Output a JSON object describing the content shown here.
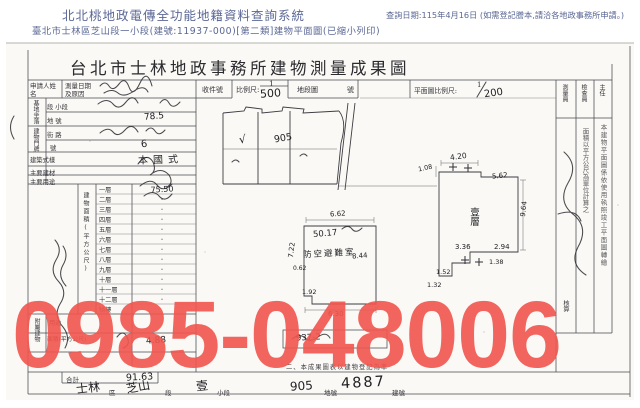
{
  "header": {
    "system_title": "北北桃地政電傳全功能地籍資料查詢系統",
    "query_note": "查詢日期:115年4月16日 (如需登記謄本,請洽各地政事務所申請。)",
    "doc_line": "臺北市士林區芝山段一小段(建號:11937-000)[第二類]建物平面圖(已縮小列印)"
  },
  "watermark": {
    "text": "0985-048006",
    "color": "#f2564e"
  },
  "form": {
    "title": "台北市士林地政事務所建物測量成果圖",
    "head": {
      "applicant": "申請人姓名",
      "survey": "測量日期及原因",
      "receipt": "收件號",
      "scale_label": "比例尺:",
      "scale_num": "1",
      "scale_den": "500",
      "sheet_label": "地段圖",
      "sheet_no": "號",
      "plan_scale_label": "平面圖比例尺:",
      "plan_scale_num": "1",
      "plan_scale_den": "200"
    },
    "info": {
      "group_site": "基地坐落",
      "group_door": "建物門牌",
      "row_section": "段 小段",
      "row_lot": "地 號",
      "lot_value": "78.5",
      "row_street": "街 路",
      "row_no": "號",
      "no_value": "6",
      "row_style": "建築式樣",
      "style_value": "本國式",
      "row_material": "主要建材",
      "row_usage": "主要用途"
    },
    "area": {
      "section_label": "建物面積(平方公尺)",
      "floor_rows": [
        {
          "label": "一層",
          "value": "75.50"
        },
        {
          "label": "二層",
          "value": "·"
        },
        {
          "label": "三層",
          "value": "·"
        },
        {
          "label": "四層",
          "value": "·"
        },
        {
          "label": "五層",
          "value": "·"
        },
        {
          "label": "六層",
          "value": "·"
        },
        {
          "label": "七層",
          "value": "·"
        },
        {
          "label": "八層",
          "value": "·"
        },
        {
          "label": "九層",
          "value": "·"
        },
        {
          "label": "十層",
          "value": "·"
        },
        {
          "label": "十一層",
          "value": "·"
        },
        {
          "label": "十二層",
          "value": "·"
        },
        {
          "label": "騎樓",
          "value": ""
        }
      ],
      "annex_label": "附屬建物",
      "annex_use": "用途",
      "annex_area_label": "面積(平方公尺)",
      "annex_value": "4.88",
      "total_label": "合計",
      "total_value": "91.63"
    },
    "sketch": {
      "check": "√",
      "lot": "905"
    },
    "basement": {
      "area_value": "50.17",
      "room": "防空避難室",
      "room_area": "8.44",
      "dim_top": "6.62",
      "dim_left": "7.22",
      "dim_bottom": "6.30",
      "dim_s1": "0.62",
      "dim_s2": "1.92"
    },
    "plan": {
      "label": "壹層",
      "dim_top": "4.20",
      "dim_topleft": "1.08",
      "dim_topright": "5.62",
      "dim_right": "9.64",
      "dim_b1": "3.36",
      "dim_b2": "2.94",
      "dim_b3": "1.38",
      "dim_b4": "1.52",
      "dim_b5": "1.32"
    },
    "margin": {
      "captions": [
        "測量員",
        "檢查員",
        "主任"
      ],
      "note_a": "本建物平面圖係依使用執照竣工平面圖轉繪",
      "note_b": "面積以平方公尺為單位計算之",
      "check": "核算"
    },
    "notes": {
      "box_value": "937-2",
      "note2": "二、本成果圖表以建物登記為準"
    },
    "land_row": {
      "district": "士林",
      "district_label": "區",
      "section": "芝山",
      "section_label": "段",
      "subsection": "壹",
      "subsection_label": "小段",
      "lot": "905",
      "lot_label": "地號",
      "building": "4887",
      "building_label": "建號"
    }
  }
}
